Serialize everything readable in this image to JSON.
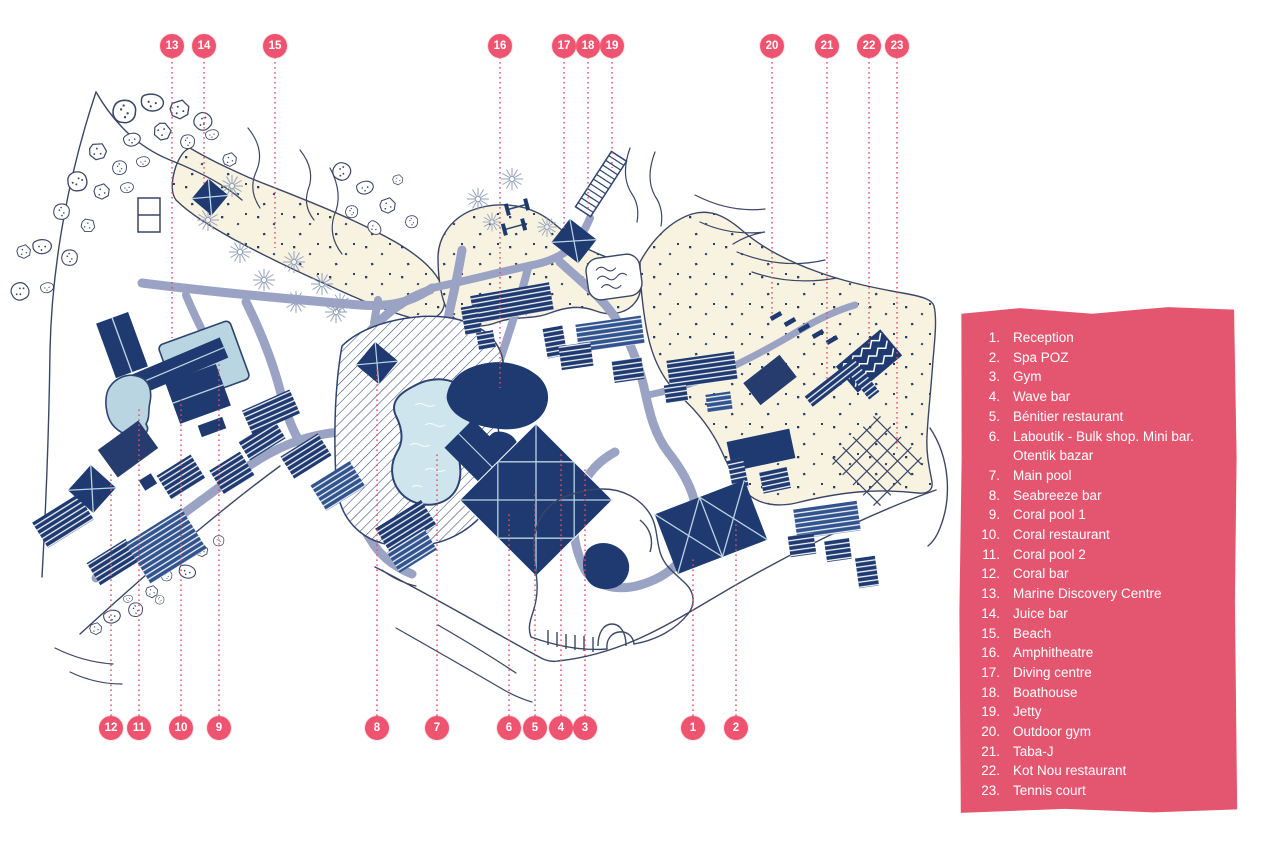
{
  "legend": {
    "items": [
      {
        "num": "1.",
        "label": "Reception"
      },
      {
        "num": "2.",
        "label": "Spa POZ"
      },
      {
        "num": "3.",
        "label": "Gym"
      },
      {
        "num": "4.",
        "label": "Wave bar"
      },
      {
        "num": "5.",
        "label": "Bénitier restaurant"
      },
      {
        "num": "6.",
        "label": "Laboutik - Bulk shop. Mini bar. Otentik bazar"
      },
      {
        "num": "7.",
        "label": "Main pool"
      },
      {
        "num": "8.",
        "label": "Seabreeze bar"
      },
      {
        "num": "9.",
        "label": "Coral pool 1"
      },
      {
        "num": "10.",
        "label": "Coral restaurant"
      },
      {
        "num": "11.",
        "label": "Coral pool 2"
      },
      {
        "num": "12.",
        "label": "Coral bar"
      },
      {
        "num": "13.",
        "label": "Marine Discovery Centre"
      },
      {
        "num": "14.",
        "label": "Juice bar"
      },
      {
        "num": "15.",
        "label": "Beach"
      },
      {
        "num": "16.",
        "label": "Amphitheatre"
      },
      {
        "num": "17.",
        "label": "Diving centre"
      },
      {
        "num": "18.",
        "label": "Boathouse"
      },
      {
        "num": "19.",
        "label": "Jetty"
      },
      {
        "num": "20.",
        "label": "Outdoor gym"
      },
      {
        "num": "21.",
        "label": "Taba-J"
      },
      {
        "num": "22.",
        "label": "Kot Nou restaurant"
      },
      {
        "num": "23.",
        "label": "Tennis court"
      }
    ]
  },
  "markers": {
    "top": [
      {
        "num": "13"
      },
      {
        "num": "14"
      },
      {
        "num": "15"
      },
      {
        "num": "16"
      },
      {
        "num": "17"
      },
      {
        "num": "18"
      },
      {
        "num": "19"
      },
      {
        "num": "20"
      },
      {
        "num": "21"
      },
      {
        "num": "22"
      },
      {
        "num": "23"
      }
    ],
    "bottom": [
      {
        "num": "12"
      },
      {
        "num": "11"
      },
      {
        "num": "10"
      },
      {
        "num": "9"
      },
      {
        "num": "8"
      },
      {
        "num": "7"
      },
      {
        "num": "6"
      },
      {
        "num": "5"
      },
      {
        "num": "4"
      },
      {
        "num": "3"
      },
      {
        "num": "1"
      },
      {
        "num": "2"
      }
    ]
  },
  "colors": {
    "legend_panel_pink": "#e4566f",
    "marker_pink": "#ee5470",
    "leader_line_red": "#dd4f66",
    "building_navy": "#1e3a70",
    "building_steel": "#31548f",
    "path_gray": "#9aa3c4",
    "beach_cream": "#f8f3e1",
    "pool_blue": "#cfe5ed",
    "light_blue": "#b9d5e2",
    "outline_slate": "#3c4766"
  }
}
